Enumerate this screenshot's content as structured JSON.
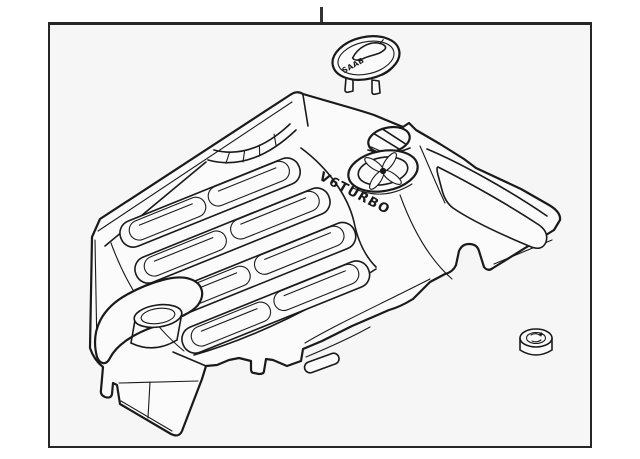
{
  "colors": {
    "line": "#1a1a1a",
    "surface": "#fbfbfb",
    "canvas": "#f6f6f6",
    "frame": "#262626",
    "tick": "#333333"
  },
  "diagram": {
    "cover_text": "V6TURBO",
    "cap_text": "SAAB",
    "parts": [
      {
        "name": "saab-emblem-cap"
      },
      {
        "name": "engine-appearance-cover"
      },
      {
        "name": "mounting-grommet"
      }
    ]
  }
}
